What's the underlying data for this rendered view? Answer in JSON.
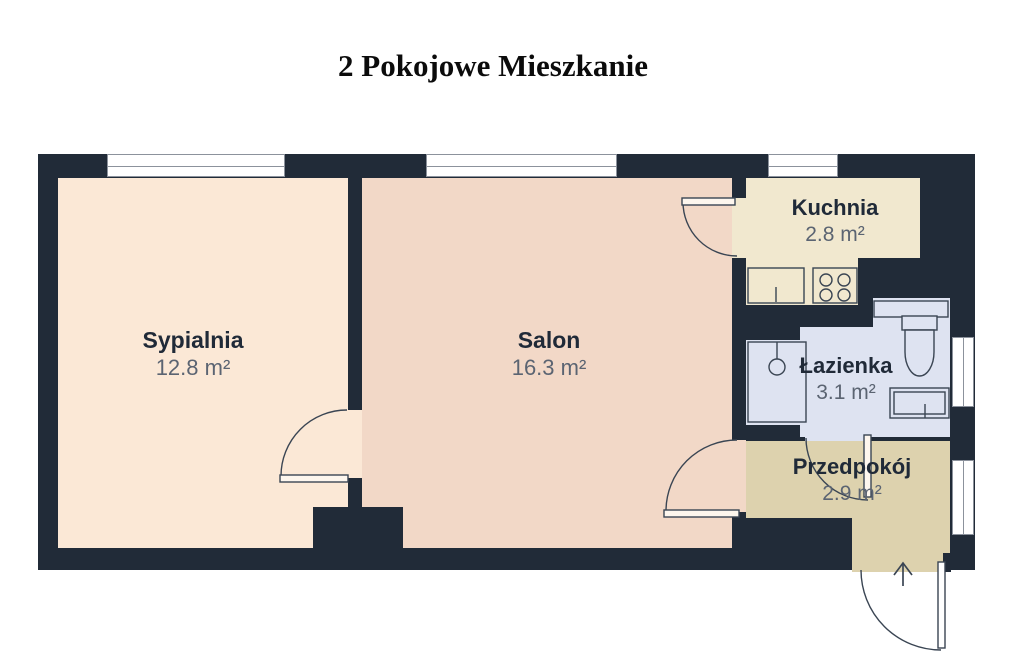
{
  "title": "2 Pokojowe Mieszkanie",
  "rooms": [
    {
      "name": "Sypialnia",
      "area": "12.8 m²",
      "floor_color": "#fbe8d6"
    },
    {
      "name": "Salon",
      "area": "16.3 m²",
      "floor_color": "#f2d8c7"
    },
    {
      "name": "Kuchnia",
      "area": "2.8 m²",
      "floor_color": "#f1e8cf"
    },
    {
      "name": "Łazienka",
      "area": "3.1 m²",
      "floor_color": "#dee3f1"
    },
    {
      "name": "Przedpokój",
      "area": "2.9 m²",
      "floor_color": "#ddd2ae"
    }
  ],
  "colors": {
    "wall": "#212b38",
    "window_fill": "#ffffff",
    "window_frame": "#8c929c",
    "door_line": "#3a4553",
    "room_name_text": "#202a38",
    "room_area_text": "#5b6472",
    "background": "#ffffff"
  },
  "doors": [
    "bedroom-door",
    "kitchen-door",
    "hallway-door",
    "bathroom-door",
    "entrance-door"
  ],
  "windows_count": 5,
  "fixtures": [
    "kitchen-sink",
    "stove-4-burner",
    "shower-tray",
    "bathroom-counter",
    "toilet",
    "bathroom-sink",
    "entrance-arrow"
  ]
}
